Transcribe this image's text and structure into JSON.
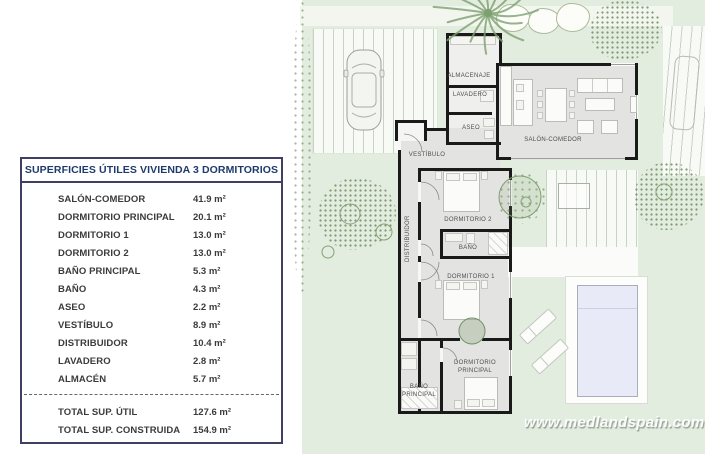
{
  "watermark": {
    "text": "www.medlandspain.com"
  },
  "table": {
    "title": "SUPERFICIES ÚTILES VIVIENDA 3 DORMITORIOS",
    "rows": [
      {
        "label": "SALÓN-COMEDOR",
        "value": "41.9 m²"
      },
      {
        "label": "DORMITORIO PRINCIPAL",
        "value": "20.1 m²"
      },
      {
        "label": "DORMITORIO 1",
        "value": "13.0 m²"
      },
      {
        "label": "DORMITORIO 2",
        "value": "13.0 m²"
      },
      {
        "label": "BAÑO PRINCIPAL",
        "value": "5.3 m²"
      },
      {
        "label": "BAÑO",
        "value": "4.3 m²"
      },
      {
        "label": "ASEO",
        "value": "2.2 m²"
      },
      {
        "label": "VESTÍBULO",
        "value": "8.9 m²"
      },
      {
        "label": "DISTRIBUIDOR",
        "value": "10.4 m²"
      },
      {
        "label": "LAVADERO",
        "value": "2.8 m²"
      },
      {
        "label": "ALMACÉN",
        "value": "5.7 m²"
      }
    ],
    "totals": [
      {
        "label": "TOTAL SUP. ÚTIL",
        "value": "127.6 m²"
      },
      {
        "label": "TOTAL SUP. CONSTRUIDA",
        "value": "154.9 m²"
      }
    ]
  },
  "floorplan": {
    "rooms": [
      {
        "label": "ALMACENAJE"
      },
      {
        "label": "LAVADERO"
      },
      {
        "label": "ASEO"
      },
      {
        "label": "SALÓN-COMEDOR"
      },
      {
        "label": "VESTÍBULO"
      },
      {
        "label": "DISTRIBUIDOR"
      },
      {
        "label": "DORMITORIO 2"
      },
      {
        "label": "BAÑO"
      },
      {
        "label": "DORMITORIO 1"
      },
      {
        "label": "DORMITORIO PRINCIPAL"
      },
      {
        "label": "BAÑO PRINCIPAL"
      }
    ]
  },
  "colors": {
    "garden": "#e2ecdf",
    "room_floor": "#e3e3e2",
    "wall": "#1a1a1a",
    "pool": "#e8eaf7",
    "table_title": "#1e3a6e",
    "table_border": "#3f3f63",
    "foliage": "#7da06f"
  }
}
